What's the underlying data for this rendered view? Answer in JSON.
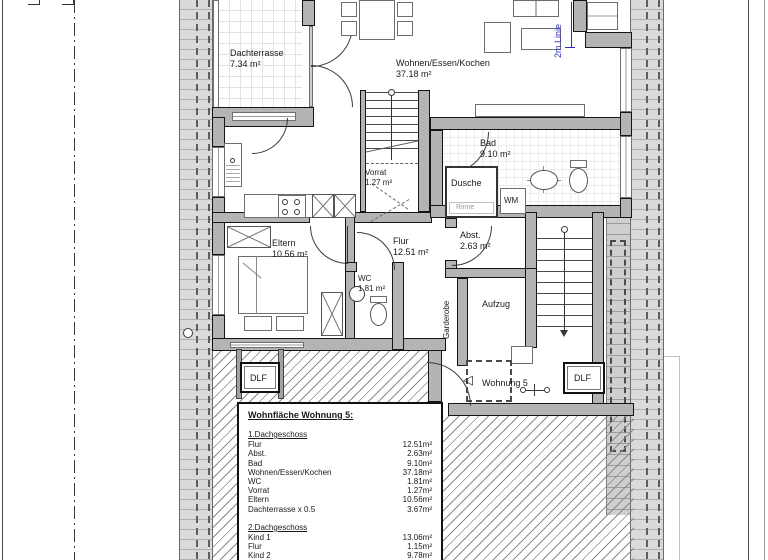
{
  "rooms": {
    "dachterrasse": {
      "name": "Dachterrasse",
      "area": "7.34 m²"
    },
    "wohnen": {
      "name": "Wohnen/Essen/Kochen",
      "area": "37.18 m²"
    },
    "bad": {
      "name": "Bad",
      "area": "9.10 m²"
    },
    "flur": {
      "name": "Flur",
      "area": "12.51 m²"
    },
    "wc": {
      "name": "WC",
      "area": "1.81 m²"
    },
    "vorrat": {
      "name": "Vorrat",
      "area": "1.27 m²"
    },
    "eltern": {
      "name": "Eltern",
      "area": "10.56 m²"
    },
    "abst": {
      "name": "Abst.",
      "area": "2.63 m²"
    }
  },
  "fixtures": {
    "dusche": "Dusche",
    "rinne": "Rinne",
    "wm": "WM",
    "aufzug": "Aufzug",
    "garderobe": "Garderobe"
  },
  "annotations": {
    "two_m_line": "2m Linie",
    "wohnung": "Wohnung 5",
    "dlf_left": "DLF",
    "dlf_right": "DLF"
  },
  "area_table": {
    "title": "Wohnfläche Wohnung 5:",
    "sections": [
      {
        "header": "1.Dachgeschoss",
        "rows": [
          {
            "name": "Flur",
            "value": "12.51m²"
          },
          {
            "name": "Abst.",
            "value": "2.63m²"
          },
          {
            "name": "Bad",
            "value": "9.10m²"
          },
          {
            "name": "Wohnen/Essen/Kochen",
            "value": "37.18m²"
          },
          {
            "name": "WC",
            "value": "1.81m²"
          },
          {
            "name": "Vorrat",
            "value": "1.27m²"
          },
          {
            "name": "Eltern",
            "value": "10.56m²"
          },
          {
            "name": "Dachterrasse x 0.5",
            "value": "3.67m²"
          }
        ]
      },
      {
        "header": "2.Dachgeschoss",
        "rows": [
          {
            "name": "Kind 1",
            "value": "13.06m²"
          },
          {
            "name": "Flur",
            "value": "1.15m²"
          },
          {
            "name": "Kind 2",
            "value": "9.78m²"
          }
        ]
      }
    ],
    "total": "102.72m²",
    "deduction": {
      "name": "- 2% Putz",
      "value": "-2.05m²"
    }
  },
  "colors": {
    "accent_blue": "#2f2fbe",
    "wall_gray": "#b4b4b4",
    "roof_band_gray": "#dadada",
    "hatch_gray": "#8a8a8a"
  }
}
